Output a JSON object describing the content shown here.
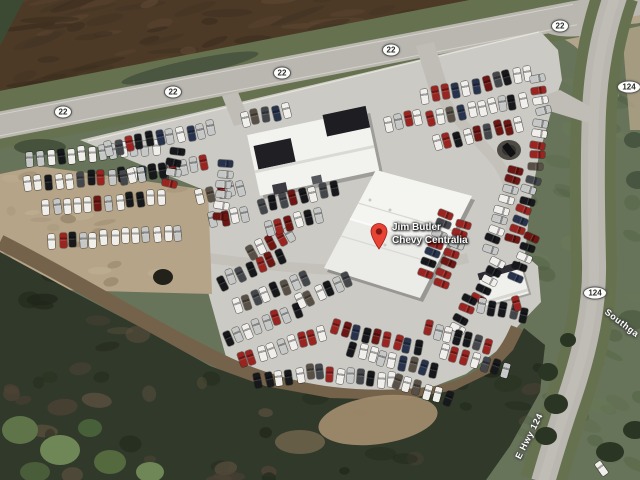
{
  "map": {
    "place": {
      "name_line1": "Jim Butler",
      "name_line2": "Chevy Centralia",
      "pin_color": "#E94335",
      "pin_hole_color": "#7E1812"
    },
    "route_shields": [
      {
        "label": "22",
        "x": 63,
        "y": 112
      },
      {
        "label": "22",
        "x": 173,
        "y": 92
      },
      {
        "label": "22",
        "x": 282,
        "y": 73
      },
      {
        "label": "22",
        "x": 391,
        "y": 50
      },
      {
        "label": "22",
        "x": 560,
        "y": 26
      },
      {
        "label": "124",
        "x": 629,
        "y": 87
      },
      {
        "label": "124",
        "x": 595,
        "y": 293
      }
    ],
    "road_labels": [
      {
        "text": "Southga",
        "x": 622,
        "y": 323,
        "angle": 37
      },
      {
        "text": "E Hwy 124",
        "x": 529,
        "y": 436,
        "angle": -63
      }
    ],
    "vehicles": {
      "palette": {
        "white": "#f0efec",
        "silver": "#c6c8c7",
        "black": "#17181b",
        "dark_gray": "#43464a",
        "red": "#9a2420",
        "dark_red": "#6d1512",
        "blue": "#27324d",
        "tan": "#585046"
      },
      "car_rows": [
        {
          "x": 30,
          "y": 160,
          "a": -6,
          "n": 13,
          "m": "light"
        },
        {
          "x": 28,
          "y": 184,
          "a": -5,
          "n": 14,
          "m": "base"
        },
        {
          "x": 46,
          "y": 208,
          "a": -5,
          "n": 12,
          "m": "base"
        },
        {
          "x": 52,
          "y": 242,
          "a": -4,
          "n": 13,
          "m": "light"
        },
        {
          "x": 108,
          "y": 148,
          "a": -11,
          "n": 11,
          "m": "base"
        },
        {
          "x": 122,
          "y": 178,
          "a": -11,
          "n": 9,
          "m": "base"
        },
        {
          "x": 200,
          "y": 196,
          "a": -12,
          "n": 5,
          "m": "base"
        },
        {
          "x": 214,
          "y": 220,
          "a": -12,
          "n": 4,
          "m": "base"
        },
        {
          "x": 245,
          "y": 120,
          "a": -12,
          "n": 5,
          "m": "base"
        },
        {
          "x": 388,
          "y": 124,
          "a": -12,
          "n": 4,
          "m": "base"
        },
        {
          "x": 226,
          "y": 164,
          "a": 96,
          "n": 6,
          "m": "base"
        },
        {
          "x": 176,
          "y": 152,
          "a": 100,
          "n": 4,
          "m": "base"
        },
        {
          "x": 425,
          "y": 96,
          "a": -12,
          "n": 11,
          "m": "base"
        },
        {
          "x": 430,
          "y": 119,
          "a": -12,
          "n": 10,
          "m": "base"
        },
        {
          "x": 437,
          "y": 143,
          "a": -13,
          "n": 9,
          "m": "red"
        },
        {
          "x": 536,
          "y": 80,
          "a": 78,
          "n": 4,
          "m": "base"
        },
        {
          "x": 540,
          "y": 124,
          "a": 96,
          "n": 5,
          "m": "base"
        },
        {
          "x": 516,
          "y": 170,
          "a": 108,
          "n": 9,
          "m": "base"
        },
        {
          "x": 533,
          "y": 180,
          "a": 108,
          "n": 7,
          "m": "red"
        },
        {
          "x": 498,
          "y": 262,
          "a": 116,
          "n": 5,
          "m": "base"
        },
        {
          "x": 470,
          "y": 300,
          "a": 115,
          "n": 4,
          "m": "dark"
        },
        {
          "x": 446,
          "y": 214,
          "a": 110,
          "n": 7,
          "m": "base"
        },
        {
          "x": 463,
          "y": 224,
          "a": 110,
          "n": 7,
          "m": "red"
        },
        {
          "x": 222,
          "y": 282,
          "a": -24,
          "n": 7,
          "m": "base"
        },
        {
          "x": 236,
          "y": 306,
          "a": -22,
          "n": 8,
          "m": "base"
        },
        {
          "x": 252,
          "y": 252,
          "a": -25,
          "n": 5,
          "m": "base"
        },
        {
          "x": 262,
          "y": 206,
          "a": -14,
          "n": 8,
          "m": "dark"
        },
        {
          "x": 268,
          "y": 228,
          "a": -14,
          "n": 6,
          "m": "base"
        },
        {
          "x": 228,
          "y": 338,
          "a": -22,
          "n": 8,
          "m": "base"
        },
        {
          "x": 242,
          "y": 360,
          "a": -18,
          "n": 9,
          "m": "base"
        },
        {
          "x": 258,
          "y": 382,
          "a": -10,
          "n": 7,
          "m": "base"
        },
        {
          "x": 330,
          "y": 374,
          "a": 6,
          "n": 7,
          "m": "base"
        },
        {
          "x": 398,
          "y": 382,
          "a": 18,
          "n": 6,
          "m": "base"
        },
        {
          "x": 336,
          "y": 327,
          "a": 14,
          "n": 9,
          "m": "red"
        },
        {
          "x": 352,
          "y": 350,
          "a": 14,
          "n": 9,
          "m": "base"
        },
        {
          "x": 300,
          "y": 302,
          "a": -24,
          "n": 6,
          "m": "base"
        },
        {
          "x": 428,
          "y": 328,
          "a": 16,
          "n": 7,
          "m": "dark"
        },
        {
          "x": 444,
          "y": 352,
          "a": 16,
          "n": 7,
          "m": "red"
        },
        {
          "x": 532,
          "y": 238,
          "a": 112,
          "n": 5,
          "m": "base"
        },
        {
          "x": 482,
          "y": 306,
          "a": 12,
          "n": 5,
          "m": "dark"
        }
      ],
      "road_vehicles": [
        {
          "x": 516,
          "y": 303,
          "angle": 75,
          "color": "red"
        },
        {
          "x": 601,
          "y": 468,
          "angle": 55,
          "color": "white"
        }
      ]
    }
  }
}
